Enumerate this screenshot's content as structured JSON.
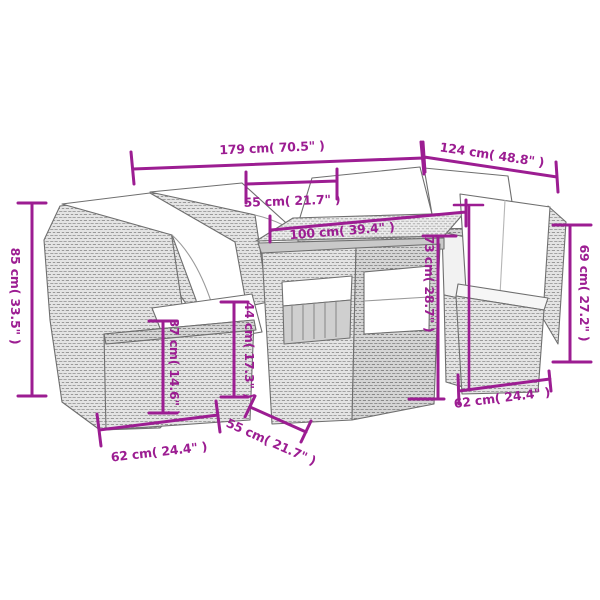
{
  "image": {
    "background": "#ffffff",
    "accent": "#9c1d92",
    "furniture_fill": "#e4e4e4",
    "furniture_stroke": "#6f6f6f",
    "cushion_fill": "#ffffff"
  },
  "dimensions": {
    "total_width": {
      "label": "179 cm( 70.5\" )"
    },
    "total_depth": {
      "label": "124 cm( 48.8\" )"
    },
    "table_width": {
      "label": "55 cm( 21.7\" )"
    },
    "table_length": {
      "label": "100 cm( 39.4\" )"
    },
    "sofa_height": {
      "label": "85 cm( 33.5\" )"
    },
    "seat_base_height": {
      "label": "37 cm( 14.6\" )"
    },
    "arm_height": {
      "label": "44 cm( 17.3\" )"
    },
    "table_height": {
      "label": "73 cm( 28.7\" )"
    },
    "chair_height": {
      "label": "69 cm( 27.2\" )"
    },
    "seat_width_left": {
      "label": "62 cm( 24.4\" )"
    },
    "seat_depth": {
      "label": "55 cm( 21.7\" )"
    },
    "seat_width_right": {
      "label": "62 cm( 24.4\" )"
    }
  }
}
